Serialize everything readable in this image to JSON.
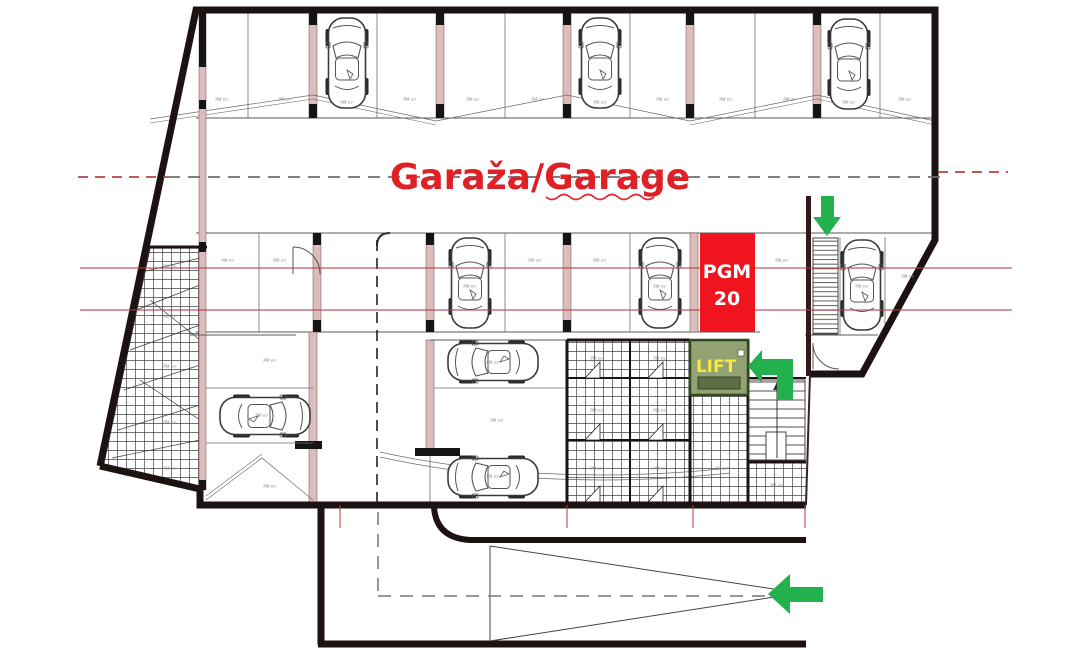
{
  "plan": {
    "title": "Garaža/Garage",
    "unit_marker": {
      "line1": "PGM",
      "line2": "20"
    },
    "lift_label": "LIFT",
    "stall_label": "PM m²",
    "colors": {
      "title_red": "#df2027",
      "marker_red": "#f0141e",
      "marker_text": "#ffffff",
      "lift_fill": "#94a173",
      "lift_border": "#2f4a23",
      "lift_text": "#f5ea3d",
      "arrow_green": "#22b14c",
      "wall_black": "#1d1212",
      "grid_red": "#b0403a"
    }
  }
}
